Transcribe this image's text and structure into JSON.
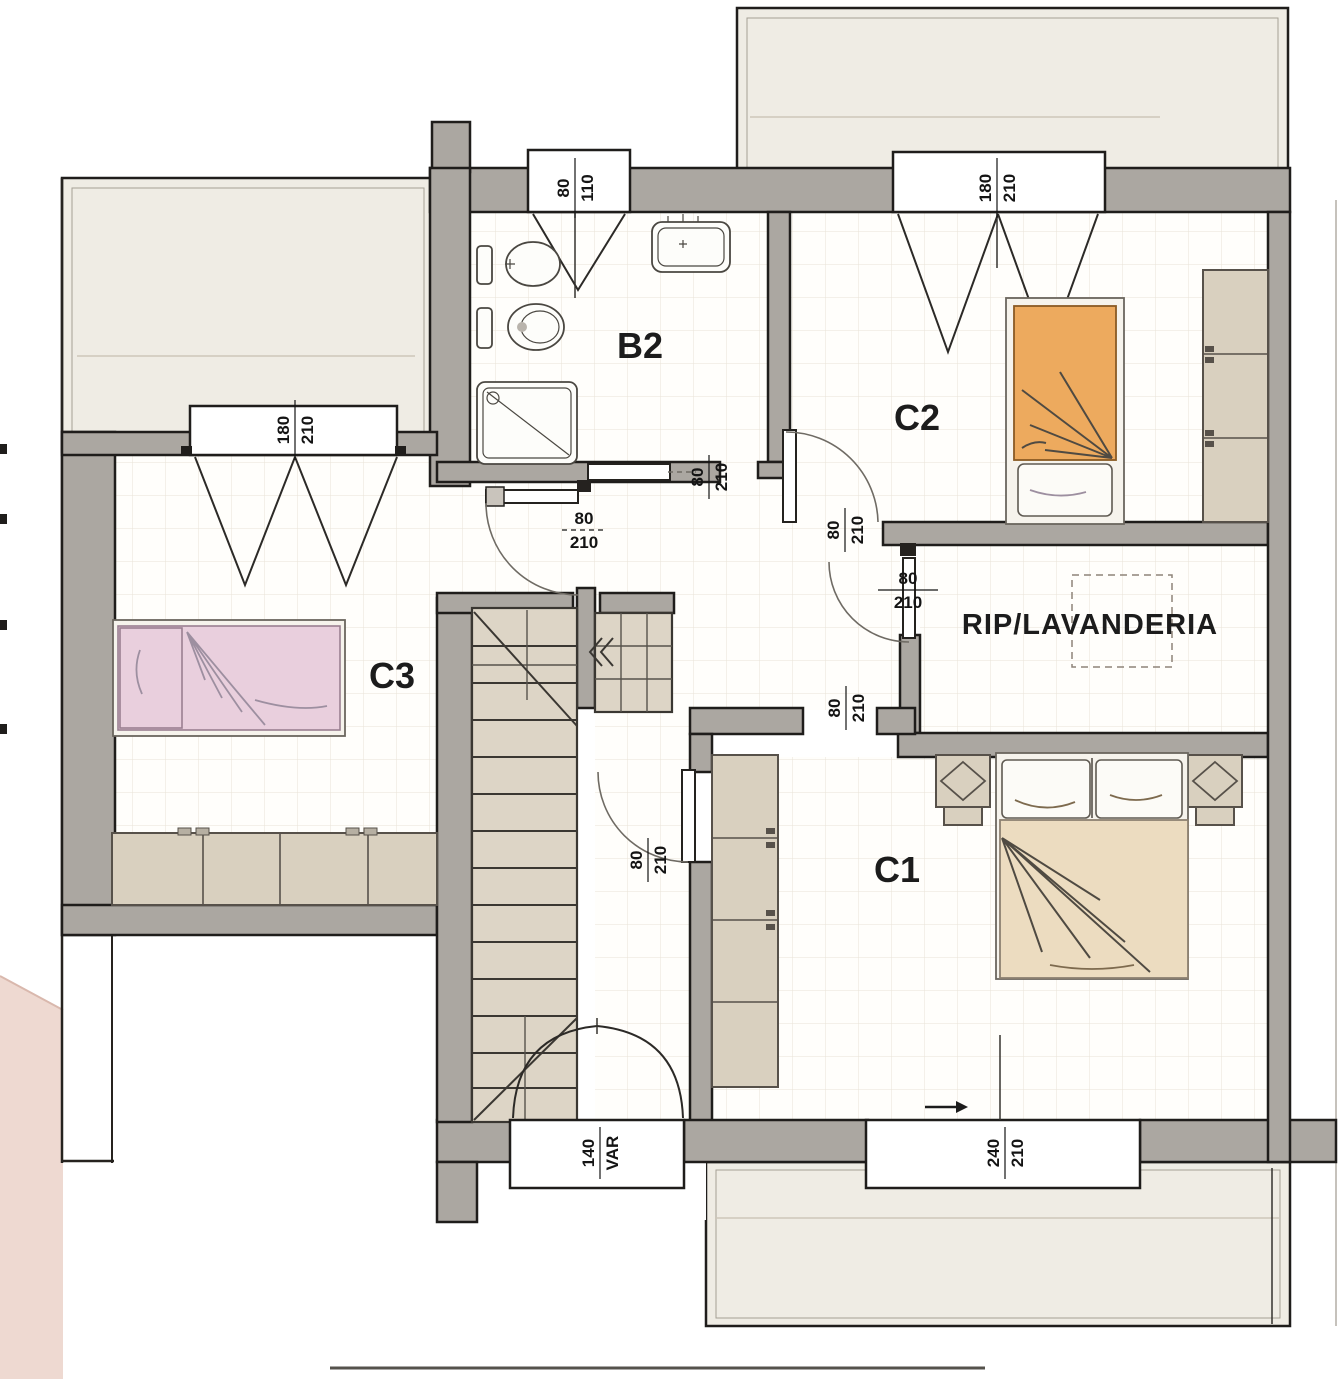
{
  "document": {
    "kind": "scanned floor plan, upper storey of apartment"
  },
  "rooms": {
    "b2": {
      "label": "B2"
    },
    "c2": {
      "label": "C2"
    },
    "c3": {
      "label": "C3"
    },
    "c1": {
      "label": "C1"
    },
    "rip": {
      "label": "RIP/LAVANDERIA"
    }
  },
  "dims": {
    "b2_window": {
      "w": "80",
      "h": "110"
    },
    "c2_window": {
      "w": "180",
      "h": "210"
    },
    "c3_window": {
      "w": "180",
      "h": "210"
    },
    "b2_door": {
      "w": "80",
      "h": "210"
    },
    "corridor_door": {
      "w": "80",
      "h": "210"
    },
    "c2_door": {
      "w": "80",
      "h": "210"
    },
    "rip_door": {
      "w": "80",
      "h": "210"
    },
    "hall_door": {
      "w": "80",
      "h": "210"
    },
    "c1_door": {
      "w": "80",
      "h": "210"
    },
    "stairs_window": {
      "w": "140",
      "h": "VAR"
    },
    "c1_window": {
      "w": "240",
      "h": "210"
    }
  },
  "colors": {
    "wall": "#aba7a1",
    "wall-outline": "#1f1d1b",
    "floor-grid": "#e9e3d7",
    "terrace": "#efece4",
    "furniture": "#d9d0bf",
    "furniture-line": "#57514a",
    "stairs": "#ddd5c6",
    "bed-orange": "#edaa5e",
    "bed-pink": "#e9cfdd",
    "bed-double": "#ecdcc0",
    "accent-pink": "#eed9d1",
    "ink": "#1c1c1c"
  }
}
